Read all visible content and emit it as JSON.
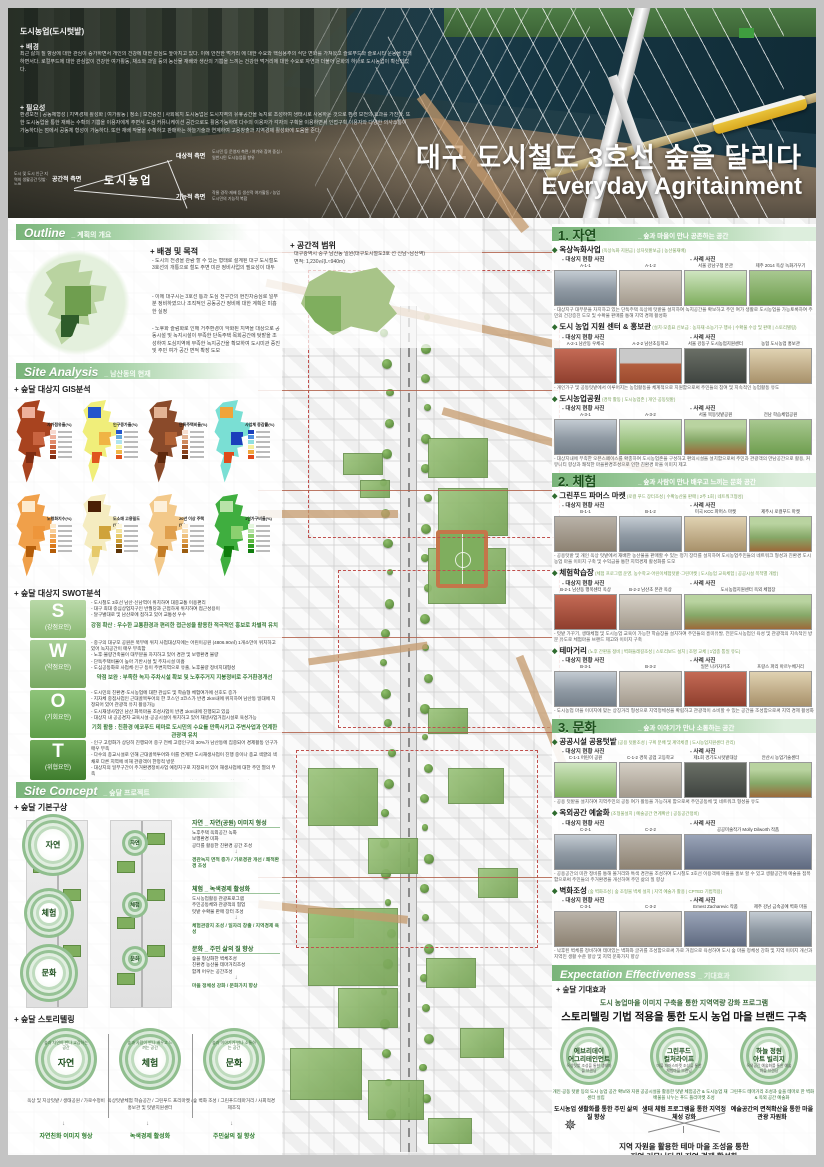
{
  "hero": {
    "tag": "도시농업(도시텃밭)",
    "background_title": "+ 배경",
    "background_text": "최근 삶의 질 향상에 대한 관심이 증가하면서 개인의 건강에 대한 관심도 높아지고 있다. 이에 안전한 먹거리 에 대한 수요와 핵심용주의 식단 변화를 가져왔고 슬로푸드와 슬로시티 운동을 전개하면서다. 로컬푸드에 대한 관심없이 건강한 여가활동, 채소와 과일 등의 농산물 재배와 생산의 기쁨을 느끼는 건강한 먹거리에 대한 수요로 자연과 더불어 문화의 하나로 도시농업이 확산되었다.",
    "need_title": "+ 필요성",
    "need_text": "환경보전 | 공동체형성 | 지역경제 활성화 | 여가활동 | 청소 | 보건증진 | 사회복지 도시농업은 도시지역의 유휴공간을 녹지로 조성하여 생태시로 사용하는 것으로 환경 보전의 효과를 가진다. 또한 도시농업을 통한 재배는 수확의 기쁨을 이용자에게 주면서 도심 커뮤니케이션 공간으로도 활용가능하며 다수의 이용자가 각자의 구획을 이용하면서 인접구획 이용자와 다양한 의사소통이 가능하다는 점에서 공동체 형성이 가능하다. 또한 재배 작물을 수확하고 판매하는 하늘기술과 연계하여 고용창출과 지역경제 활성화에 도움을 준다.",
    "diagram": {
      "center": "도시농업",
      "target": "대상적 측면",
      "target_note": "도시민 등 운영자 측면 / 여가와 참여 중심 / 일반시민 도시농업을 향유",
      "space": "공간적 측면",
      "space_note": "도시 및 도시 인근 지역의 생활공간 텃밭·농원",
      "func": "기능적 측면",
      "func_note": "작물 경작·재배 등 생산적 여가활동 / 농업 도시민의 기능적 복합"
    },
    "title_ko": "대구 도시철도 3호선 숲을 달리다",
    "title_en": "Everyday Agritainment"
  },
  "outline": {
    "header": "Outline",
    "header_sub": "_ 계획의 개요",
    "goal_title": "+ 배경 및 목적",
    "goal_bullets": [
      "- 도시의 전경을 관람 할 수 있는 형태로 설계된 대구 도시철도 3호선의 개통으로 철도 주변 미관 정비사업의 필요성이 대두",
      "- 이에 대구시는 3호선 통과 도심 천구간의 현진차중심로 일부분 정비하였으나 조직적인 공동공간 정비에 대한 계획은 미흡한 실정",
      "- 노후화 슬럼화로 인해 거주환경이 악화된 지역을 대상으로 공동시설 및 녹지시설이 부족한 단독주택 목회공간에 텃밭을 조성하여 도심지역에 부족한 녹지공간을 확보하여 도시미관 증진 및 주민 여가 공간 면적 확장 도모"
    ],
    "scope_title": "+ 공간적 범위",
    "scope_line1": "대구광역시 중구 남산동 일원(대구도시철도3호 선 신남~남산역)",
    "scope_line2": "면적: 1,230㎡(L≈940m)"
  },
  "site_analysis": {
    "header": "Site Analysis",
    "header_sub": "_ 남산동의 현재",
    "gis_title": "+ 숲달 대상지 GIS분석",
    "gis_maps": [
      {
        "label": "자가점유율(%)",
        "main": "#a8431f",
        "patches": [
          "#eeb09b",
          "#c96440",
          "#7e2c12"
        ],
        "palette": [
          "#f7d9cf",
          "#eeb09b",
          "#e08a6b",
          "#c96440",
          "#a8431f",
          "#7e2c12"
        ]
      },
      {
        "label": "인구증가율(%)",
        "main": "#f0ee7a",
        "patches": [
          "#2255cc",
          "#f0b445",
          "#e0551f"
        ],
        "palette": [
          "#2255cc",
          "#66aadd",
          "#aee3ee",
          "#f5f2a0",
          "#f0b445",
          "#e0551f"
        ]
      },
      {
        "label": "단독주택비율(%)",
        "main": "#8a4a2a",
        "patches": [
          "#e3b394",
          "#b06134",
          "#5f2a0e"
        ],
        "palette": [
          "#f5ddd0",
          "#e3b394",
          "#cf8a5e",
          "#b06134",
          "#8a421c",
          "#5f2a0e"
        ]
      },
      {
        "label": "사업체 증감률(%)",
        "main": "#7adfd4",
        "patches": [
          "#f0a43a",
          "#1a3fbb",
          "#e04a1a"
        ],
        "palette": [
          "#1a3fbb",
          "#4d8fe0",
          "#8fe0e0",
          "#f5f0a0",
          "#f0a43a",
          "#e04a1a"
        ]
      },
      {
        "label": "노령화지수(%)",
        "main": "#f0a04a",
        "patches": [
          "#fdeacc",
          "#ee963b",
          "#b35c08"
        ],
        "palette": [
          "#fdeacc",
          "#f8cf9a",
          "#f3b369",
          "#ee963b",
          "#d97718",
          "#b35c08"
        ]
      },
      {
        "label": "도소매 고용밀도(%)",
        "main": "#f5ecc0",
        "patches": [
          "#4a1f05",
          "#cfa33a",
          "#e6c96a"
        ],
        "palette": [
          "#fdf6d8",
          "#f3e3a0",
          "#e6c96a",
          "#cfa33a",
          "#9c6a14",
          "#5c3305"
        ]
      },
      {
        "label": "20년 이상 주택(%)",
        "main": "#f3c98a",
        "patches": [
          "#fdf0da",
          "#e0a04e",
          "#c47d26"
        ],
        "palette": [
          "#fdf0da",
          "#f7dcb0",
          "#eec07e",
          "#e0a04e",
          "#c47d26",
          "#9a5c10"
        ]
      },
      {
        "label": "1인가구비율(%)",
        "main": "#3fae3f",
        "patches": [
          "#b8e3a8",
          "#8bd06f",
          "#0f7d0d"
        ],
        "palette": [
          "#e3f5dc",
          "#b8e3a8",
          "#8bd06f",
          "#5bb83f",
          "#2f9e22",
          "#0f7d0d"
        ]
      }
    ],
    "swot_title": "+ 숲달 대상지 SWOT분석",
    "swot": [
      {
        "letter": "S",
        "type": "(강점요인)",
        "bullets": [
          "- 도시철도 3호선 남산·신남역이 위치하여 대중교통 이용편리",
          "- 대구 최대 중심상업지구인 반월당과 근접하게 위치하여 접근성용이",
          "- 달구벌대로 및 남산로에 접하고 있어 교통성 우수"
        ],
        "summary": "강점 확산 : 우수한 교통환경과 편리한 접근성을 활용한 적극적인 홍보로 차별적 유치"
      },
      {
        "letter": "W",
        "type": "(약점요인)",
        "bullets": [
          "- 중구의 대규모 공원은 북부에 위치 사업대상지에는 어린이공원 (4806.90㎡) 1개소만이 위치하고 있어 녹지공간이 매우 부족함",
          "- 노후·불량건축물이 대부분을 차지하고 있어 경관 및 보행환경 불량",
          "- 단독주택비율이 높아 기반시설 및 주차시설 미흡",
          "- 도심공동화로 사업체·인구 등이 주변지역으로 유출, 노후불량 정비지대형성"
        ],
        "summary": "약점 보완 : 부족한 녹지·주차시설 확보 및 노후주거지 지붕정비로 주거환경개선"
      },
      {
        "letter": "O",
        "type": "(기회요인)",
        "bullets": [
          "- 도시민의 친환경·도시농업에 대한 관심도 및 학습형 체험여가에 선호도 증가",
          "- 지자체 중점사업인 근대골목투어의 한 코스인 3코스가 반경 2km내에 위치하여 남산동 일대에 지정되어 있어 관광객 유치 활용가능",
          "- 도시재생사업인 남산 화목마을 조성사업이 반경 1km내에 진행되고 있음",
          "- 대상지 내 공공경지·교육시설·공공시설이 위치하고 있어 재생사업거점시설로 육성가능"
        ],
        "summary": "기회 활용 : 친환경 에코푸드 테마로 도시민의 수요를 만족시키고 주변사업과 연계한 관광객 유치"
      },
      {
        "letter": "T",
        "type": "(위협요인)",
        "bullets": [
          "- 인구 고령화가 상당히 진행되어 중구 전체 고령인구의 30%가 남산동에 집중되어 경제활동 인구가 매우 부족",
          "- 다수의 종교시설로 인해 근대골목투어와 이를 연계한 도시재생사업이 진행 중이나 종교 색깔의 색채로 다른 지역에 비해 관광객이 한정적 방문",
          "- 대상지의 일부구간이 주거환경정비사업 예정지구로 지정되어 있어 재생사업에 대한 주민 열의 부족"
        ],
        "summary": "고령인구 및 비경제활동인구의 일자리를 창출 할 수 있는 사회적경제조직 육성"
      }
    ]
  },
  "site_concept": {
    "header": "Site Concept",
    "header_sub": "_ 숲달 프로젝트",
    "basic_title": "+ 숲달 기본구상",
    "strip_labels": [
      "자연",
      "체험",
      "문화"
    ],
    "blocks": [
      {
        "title": "자연 _ 자연(공원) 이미지 형성",
        "bullets": [
          "노후주택 옥외공간 녹화",
          "보행환경 미화",
          "공터를 활용한 친환경 공간 조성"
        ],
        "result": "경관녹지 면적 증가 / 가로경관 개선 / 쾌적환경 조성"
      },
      {
        "title": "체험 _ 녹색경제 활성화",
        "bullets": [
          "도시농업활용 관광프로그램",
          "주민공동체와 관광객의 협업",
          "텃밭 수확물 판매 장터 조성"
        ],
        "result": "체험관광지 조성 / 일자리 창출 / 지역경제 육성"
      },
      {
        "title": "문화 _ 주민 삶의 질 향상",
        "bullets": [
          "숲을 형상화한 벽체조성",
          "친환경 농산물 테마거리조성",
          "함께 어우는 공간조성"
        ],
        "result": "마을 정체성 강화 / 문화가치 향상"
      }
    ],
    "story_title": "+ 숲달 스토리텔링",
    "story": [
      {
        "name": "자연",
        "tagline": "숲과 자연이 만나 교감하는 공간",
        "items": "옥상 및 지상텃밭 / 생태공원 / 가로수정비",
        "result": "자연친화 이미지 형상"
      },
      {
        "name": "체험",
        "tagline": "숲과 사람이 만나 배우고 느끼는 공간",
        "items": "옥상텃밭체험 학습공간 / 그린푸드 프리마켓 / 홍보관 및 텃밭지원센터",
        "result": "녹색경제 활성화"
      },
      {
        "name": "문화",
        "tagline": "숲과 이야기가 만나 소통하는 공간",
        "items": "숲 벽화 조성 / 그린푸드테마거리 / 사회적경제조직",
        "result": "주민삶의 질 향상"
      }
    ]
  },
  "right_common": {
    "current_label": "- 대상지 현황 사진",
    "case_label": "- 사례 사진"
  },
  "right_sections": [
    {
      "num": "1.",
      "name": "자연",
      "sub": "숲과 마을이 만나 공존하는 공간",
      "items": [
        {
          "title": "옥상녹화사업",
          "tags": "(옥상녹화 지원금 | 상자텃밭보급 | 농산물재배)",
          "photos": [
            {
              "label": "A-1-1",
              "tone": "street"
            },
            {
              "label": "A-1-2",
              "tone": "building"
            },
            {
              "label": "서울 강남구청 본관",
              "tone": "green"
            },
            {
              "label": "제주 2014 옥상 녹화가꾸기",
              "tone": "field"
            }
          ],
          "caption": "대상지구 대부분을 차지하고 있는 단독주택 옥상에 텃밭을 설치하여 녹지공간을 확보하고 주민 여가 생활로 도시농업을 가능토록하여 주민의 건강증진 도모 및 수확물 판매를 통해 지역 경제 활성화"
        },
        {
          "title": "도시 농업 지원 센터 & 홍보관",
          "tags": "(설치·모종묘 신보급 : 농자재·소농기구·행사 | 수확물 수상 및 판매 | 스토리텔링)",
          "photos": [
            {
              "label": "A-2-1 남산동 우체국",
              "tone": "red"
            },
            {
              "label": "A-2-2 남산초등학교",
              "tone": "track"
            },
            {
              "label": "서울 강동구 도시농업지원센터",
              "tone": "dark"
            },
            {
              "label": "농협 도시농업 홍보관",
              "tone": "market"
            }
          ],
          "caption": "개인가구 및 공동텃밭에서 이루어지는 농업활동을 체계적으로 지원함으로써 주민들의 참여 및 지속적인 농업활동 유도"
        },
        {
          "title": "도시농업공원",
          "tags": "(경작 활동 | 도시농업존 | 개인·공동텃밭)",
          "photos": [
            {
              "label": "A-3-1",
              "tone": "street"
            },
            {
              "label": "A-3-2",
              "tone": "green"
            },
            {
              "label": "서울 목동텃밭공원",
              "tone": "garden"
            },
            {
              "label": "전남 학습체험공원",
              "tone": "field"
            }
          ],
          "caption": "대상지내에 부족한 오픈스페이스를 확충하여 도시농업존을 구성하고 편의시설을 설치함으로써 주민과 관광객의 만남공간으로 활용, 커뮤니티 향상과 쾌적한 마을환경조성으로 인한 친환경 마을 이미지 제고"
        }
      ]
    },
    {
      "num": "2.",
      "name": "체험",
      "sub": "숲과 사람이 만나 배우고 느끼는 문화 공간",
      "items": [
        {
          "title": "그린푸드 파머스 마켓",
          "tags": "(로컬 푸드 장터조성 | 수확농산물 판매 | 2주 1회 | 네트워크형성)",
          "photos": [
            {
              "label": "B-1-1",
              "tone": "road"
            },
            {
              "label": "B-1-2",
              "tone": "street"
            },
            {
              "label": "미국 KCC 파머스 마켓",
              "tone": "market"
            },
            {
              "label": "제주시 로컬푸드 마켓",
              "tone": "garden"
            }
          ],
          "caption": "공용텃밭 및 개인 옥상 텃밭에서 재배한 농산물을 판매할 수 있는 정기 장터를 설치하여 도시농업주민들의 네트워크 형성과 친환경 도시농업 마을 이미지 구축 및 수익금을 통한 지역경제 활성화를 도모"
        },
        {
          "title": "체험학습장",
          "tags": "(체험 프로그램 운영, 농수학교·어린이체험텃밭·그린마켓 | 도시농업 교육체험 | 공공시설 목적별 개방)",
          "photos": [
            {
              "label": "B-2-1 남산동 행복센터 옥상",
              "tone": "red"
            },
            {
              "label": "B-2-2 남산초 본관 옥상",
              "tone": "building"
            },
            {
              "label": "도시농업지원센터 옥외 체험장",
              "tone": "garden",
              "wide": true
            }
          ],
          "caption": "텃밭 가꾸기, 생태체험 및 도시농업 교육이 가능한 학습장을 설치하여 주민들의 흥미유발, 전문도시농업인 육성 및 관광객의 지속적인 방문 유도로 체험마을 브랜드 제고와 이미지 구축"
        },
        {
          "title": "테마거리",
          "tags": "(노후 간판을 정비 | 벽화둘레길조성 | 스토리보드 설치 | 조명 교체 | 1업종 통일 유도)",
          "photos": [
            {
              "label": "B-3-1",
              "tone": "street"
            },
            {
              "label": "B-3-2",
              "tone": "building"
            },
            {
              "label": "일본 나카자키초",
              "tone": "red"
            },
            {
              "label": "프랑스 파리 아르누베거리",
              "tone": "market"
            }
          ],
          "caption": "도시농업 마을 이미지에 맞는 상징거리 형성으로 지역정체성을 확립하고 관광객이 소비할 수 있는 공간을 조성함으로써 지역 경제 활성화"
        }
      ]
    },
    {
      "num": "3.",
      "name": "문화",
      "sub": "숲과 이야기가 만나 소통하는 공간",
      "items": [
        {
          "title": "공공시설 공용텃밭",
          "tags": "(공용 텃밭조성 | 구획 분배 및 계약체결 | 도시농업지원센터 관리)",
          "photos": [
            {
              "label": "C-1-1 어린이 공원",
              "tone": "green"
            },
            {
              "label": "C-1-2 경북 공업 고등학교",
              "tone": "building"
            },
            {
              "label": "제1회 경기도시텃밭대상",
              "tone": "dark"
            },
            {
              "label": "안산시 농업기술센터",
              "tone": "garden"
            }
          ],
          "caption": "공용 텃밭을 설치하여 지역주민의 공동 여가 활동을 가능하게 함으로써 주민공동체 및 네트워크 형성을 유도"
        },
        {
          "title": "옥외공간 예술화",
          "tags": "(조형물설치 | 예술공간 연계확산 | 공동공간정비)",
          "photos": [
            {
              "label": "C-2-1",
              "tone": "street"
            },
            {
              "label": "C-2-2",
              "tone": "road"
            },
            {
              "label": "공공미술작가 Molly Dilworth 작품",
              "tone": "mural",
              "wide": true
            }
          ],
          "caption": "공용공간의 미관 정비를 통해 볼거리와 특색 경관을 조성하여 도시철도 3호선 이용객에 마을을 홍보 할 수 있고 생활공간에 예술을 접목함으로써 주민들의 주거환경을 개선하여 주민 삶의 질 향상"
        },
        {
          "title": "벽화조성",
          "tags": "(숲 벽화조성 | 숲 조형물 벽체 설치 | 지역 예술가 활용 | CPTED 기법적용)",
          "photos": [
            {
              "label": "C-3-1",
              "tone": "road"
            },
            {
              "label": "C-3-2",
              "tone": "building"
            },
            {
              "label": "Ernest Zacharevic 작품",
              "tone": "mural"
            },
            {
              "label": "제주 강남 금속공예 벽화 마을",
              "tone": "street"
            }
          ],
          "caption": "낙후된 벽체를 정비하여 테마있는 벽화와 글귀를 조성함으로써 가로 거점으로 육성하여 도시 숲 마을 정체성 강화 및 지역 이미지 개선과 지역민 생활 수준 향상 및 지역 문화가치 향상"
        }
      ]
    }
  ],
  "expectation": {
    "header": "Expectation Effectiveness",
    "header_sub": "_ 기대효과",
    "title": "+ 숲달 기대효과",
    "line1": "도시 농업마을 이미지 구축을 통한 지역역량 강화 프로그램",
    "line2": "스토리텔링 기법 적용을 통한 도시 농업 마을 브랜드 구축",
    "circles": [
      {
        "name1": "에브리데이",
        "name2": "어그리테인먼트",
        "note": "옥상텃밭 조성을 통한 생태마을 브랜딩"
      },
      {
        "name1": "그린푸드",
        "name2": "컬처라이프",
        "note": "마을 파머스마켓 조성을 통한 체험마을 브랜딩"
      },
      {
        "name1": "하늘 정원",
        "name2": "아트 빌리지",
        "note": "옥외공간 예술화를 통한 예술마을 브랜딩"
      }
    ],
    "columns": [
      {
        "note": "개인·공동 텃밭 등의 도시 농업 공간 확보와 지원센터 설립",
        "result": "도시농업 생활화를 통한 주민 삶의 질 향상"
      },
      {
        "note": "공공시설을 활용한 텃밭 체험공간 & 도시농업 재배물을 나누는 푸드 플리마켓 조성",
        "result": "생태 체험 프로그램을 통한 지역정체성 강화"
      },
      {
        "note": "그린푸드 테마거리 조성과 숲을 테마로 한 벽화 & 옥외 공간 예술화",
        "result": "예술공간의 면적확산을 통한 마을 관광 자원화"
      }
    ],
    "final1": "지역 자원을 활용한 테마 마을 조성을 통한",
    "final2": "지역 커뮤니티 및 지역 경제 활성화"
  }
}
